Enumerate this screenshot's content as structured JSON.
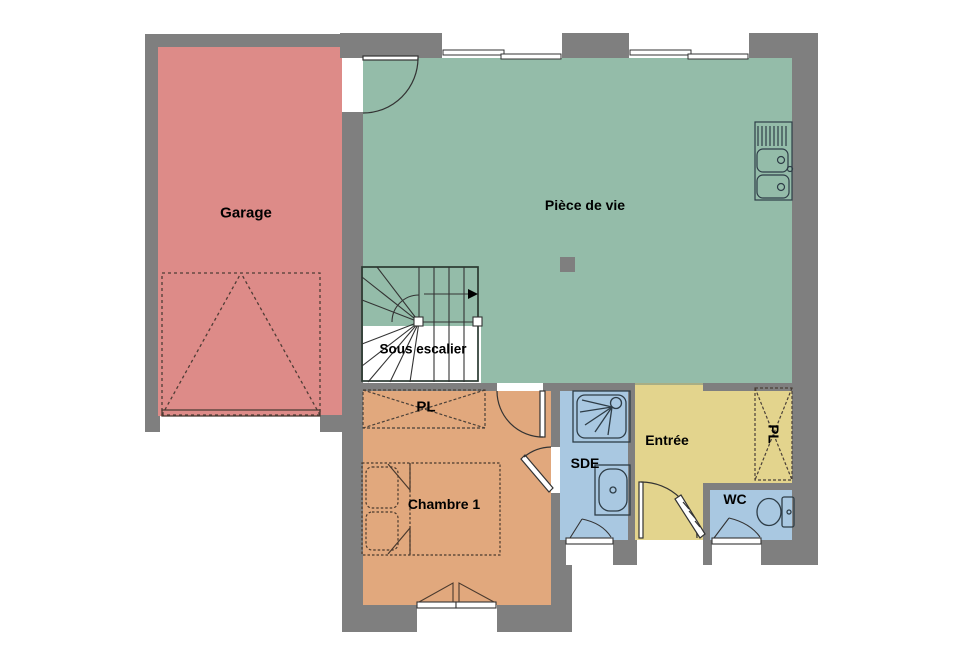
{
  "plan": {
    "type": "floor-plan",
    "language": "fr",
    "rooms": [
      {
        "id": "garage",
        "label": "Garage",
        "color": "#dd8b88"
      },
      {
        "id": "piece-de-vie",
        "label": "Pièce de vie",
        "color": "#94bca9"
      },
      {
        "id": "sous-escalier",
        "label": "Sous escalier",
        "color": "#ffffff"
      },
      {
        "id": "placard-chambre",
        "label": "PL",
        "color": "#e1a87d"
      },
      {
        "id": "chambre-1",
        "label": "Chambre 1",
        "color": "#e1a87d"
      },
      {
        "id": "sde",
        "label": "SDE",
        "color": "#a9c8e1"
      },
      {
        "id": "entree",
        "label": "Entrée",
        "color": "#e3d48d"
      },
      {
        "id": "placard-entree",
        "label": "PL",
        "color": "#e3d48d"
      },
      {
        "id": "wc",
        "label": "WC",
        "color": "#a9c8e1"
      }
    ],
    "colors": {
      "wall": "#7f7f7f",
      "background": "#ffffff",
      "fixture-outline": "#2e3d47",
      "furniture-dashed": "#4a3a2e",
      "door-line": "#333333"
    },
    "fixtures": [
      "kitchen-double-sink",
      "wood-stove-square",
      "winder-staircase-with-arrow",
      "garage-up-and-over-door",
      "double-bed-with-pillows",
      "shower-tray",
      "washbasin",
      "toilet",
      "closet-cross-chambre",
      "closet-cross-entree",
      "sliding-window-1",
      "sliding-window-2",
      "french-window-chambre",
      "casement-window-sde",
      "casement-window-wc",
      "entrance-door",
      "garage-interior-door",
      "chambre-door",
      "chambre-sde-door"
    ]
  }
}
